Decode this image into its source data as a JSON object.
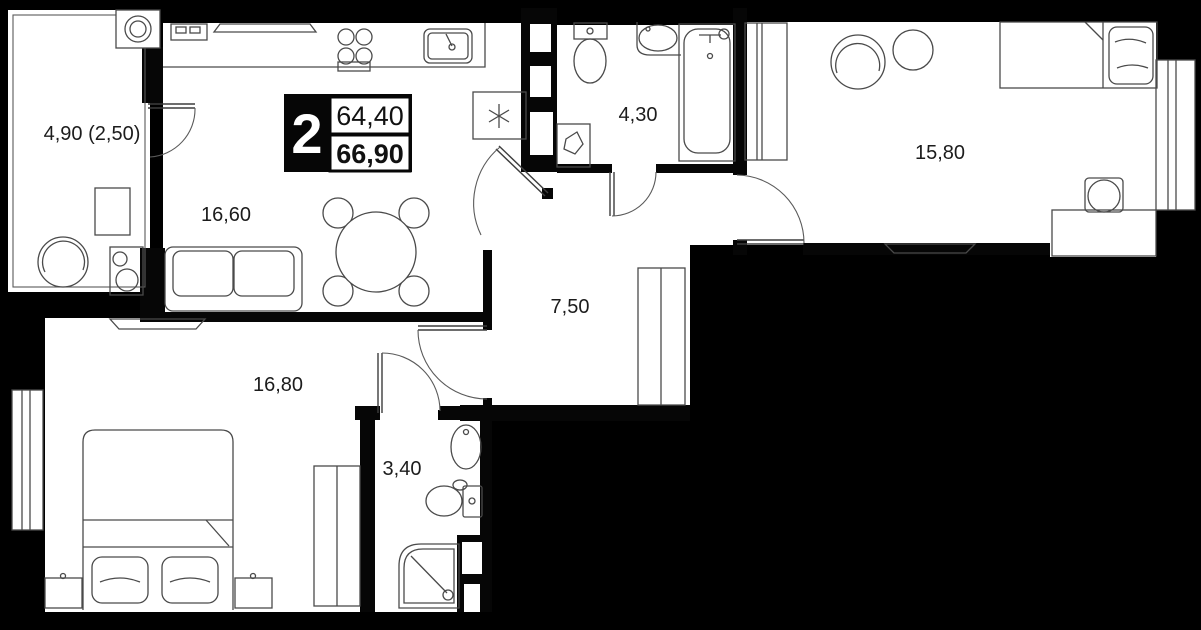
{
  "plan": {
    "title": "apartment-floor-plan",
    "badge": {
      "rooms": "2",
      "area_top": "64,40",
      "area_bottom": "66,90"
    },
    "rooms": [
      {
        "id": "balcony",
        "label": "4,90 (2,50)"
      },
      {
        "id": "kitchen-living",
        "label": "16,60"
      },
      {
        "id": "bathroom-top",
        "label": "4,30"
      },
      {
        "id": "bedroom-right",
        "label": "15,80"
      },
      {
        "id": "hallway",
        "label": "7,50"
      },
      {
        "id": "bedroom-left",
        "label": "16,80"
      },
      {
        "id": "bathroom-bottom",
        "label": "3,40"
      }
    ],
    "colors": {
      "background": "#000000",
      "floor": "#ffffff",
      "walls": "#060606",
      "furniture_line": "#4a4a4a"
    }
  }
}
